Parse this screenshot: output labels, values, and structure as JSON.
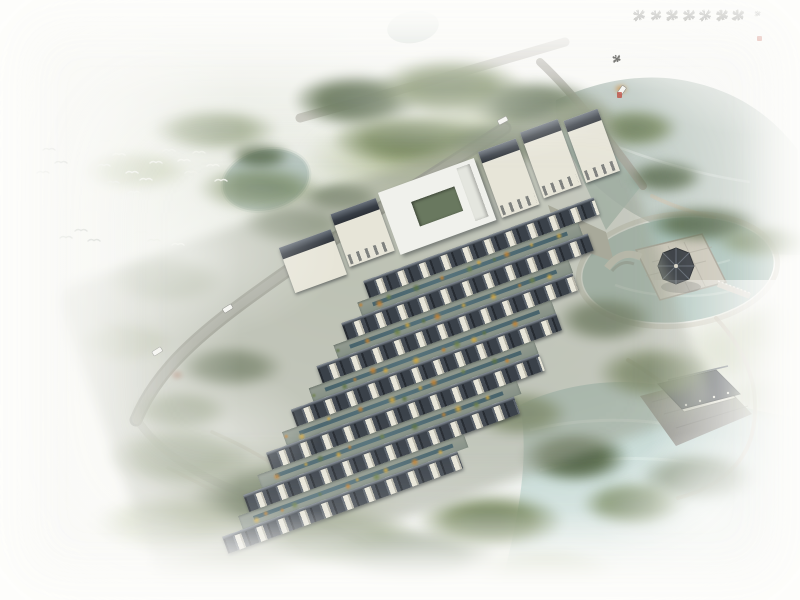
{
  "artwork": {
    "kind": "aerial-architectural-rendering",
    "subject": "chinese-courtyard-residential-resort-with-lakes-and-pavilions"
  },
  "calligraphy": {
    "date_inscription": "庚寅孟夏",
    "columns": [
      "當軒誰種碧梧桐為",
      "愛禪房翠靄中半榻",
      "茶煙浮白雪一簾花",
      "雨落晴空樹色溪聲",
      "隨意好佳日山光入",
      "望同擬向此間結茅",
      "屋白雲深處老吟翁"
    ],
    "signature": "白雲山房主人書",
    "ink_color": "#2e2e2a",
    "seal_color": "#b5392b",
    "seal_count": 2
  },
  "scene_counts": {
    "white_birds": 24,
    "vehicles": 4,
    "townhouse_rows": 7,
    "island_pavilion": 1,
    "waterside_pavilion": 1
  },
  "palette": {
    "background": "#fafaf7",
    "forest_dark": "#44563a",
    "forest_mid": "#5f7345",
    "forest_light": "#83955c",
    "lawn": "#93a269",
    "lake_top": "#b6c3bc",
    "lake_bottom": "#bdd4d0",
    "pond": "#a6bfb7",
    "road": "#9d9c95",
    "path": "#cfc9ba",
    "roof_dark": "#343a41",
    "wall_light": "#eae8db",
    "stone": "#c9c5b7",
    "autumn_orange": "#c5812f",
    "autumn_yellow": "#d4a83e",
    "accent_red": "#b04a2e"
  }
}
